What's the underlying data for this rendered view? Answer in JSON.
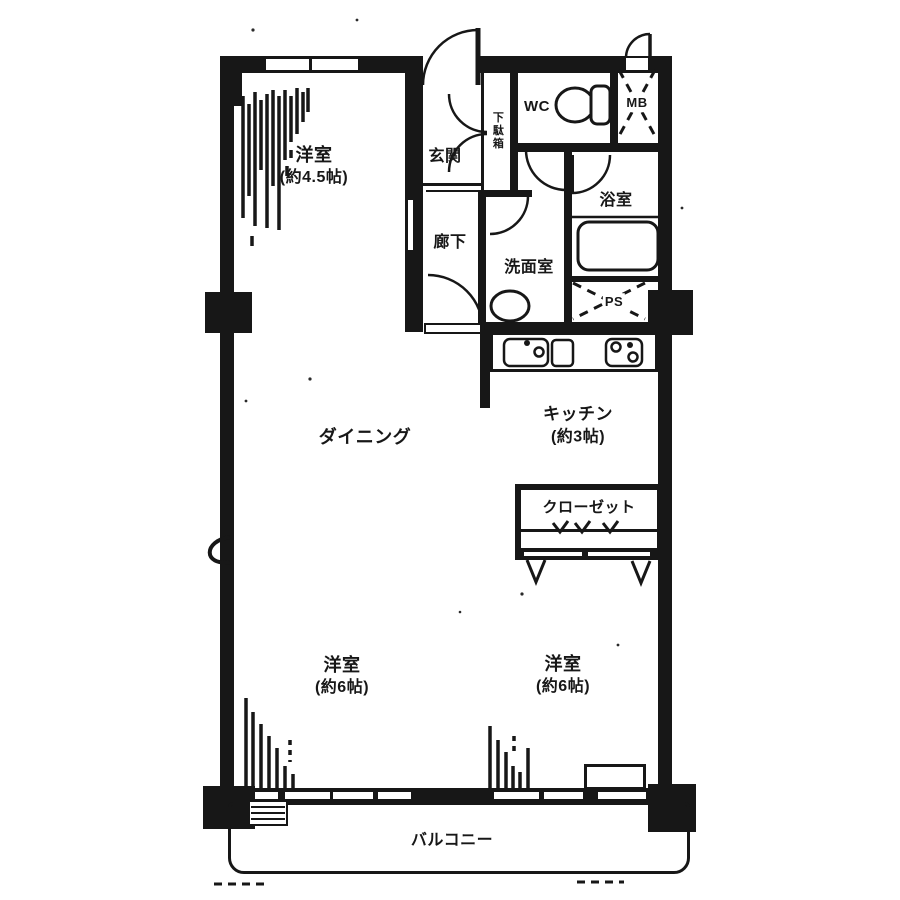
{
  "plan": {
    "type": "apartment-floor-plan",
    "colors": {
      "line": "#171717",
      "background": "#ffffff"
    },
    "rooms": [
      {
        "id": "bedroom-top",
        "label": "洋室",
        "size": "(約4.5帖)"
      },
      {
        "id": "entrance",
        "label": "玄関"
      },
      {
        "id": "shoe-cabinet",
        "label": "下駄箱"
      },
      {
        "id": "wc",
        "label": "WC"
      },
      {
        "id": "meter-box",
        "label": "MB"
      },
      {
        "id": "bathroom",
        "label": "浴室"
      },
      {
        "id": "hallway",
        "label": "廊下"
      },
      {
        "id": "washroom",
        "label": "洗面室"
      },
      {
        "id": "pipe-space",
        "label": "PS"
      },
      {
        "id": "dining",
        "label": "ダイニング"
      },
      {
        "id": "kitchen",
        "label": "キッチン",
        "size": "(約3帖)"
      },
      {
        "id": "closet",
        "label": "クローゼット"
      },
      {
        "id": "bedroom-left",
        "label": "洋室",
        "size": "(約6帖)"
      },
      {
        "id": "bedroom-right",
        "label": "洋室",
        "size": "(約6帖)"
      },
      {
        "id": "balcony",
        "label": "バルコニー"
      }
    ]
  }
}
